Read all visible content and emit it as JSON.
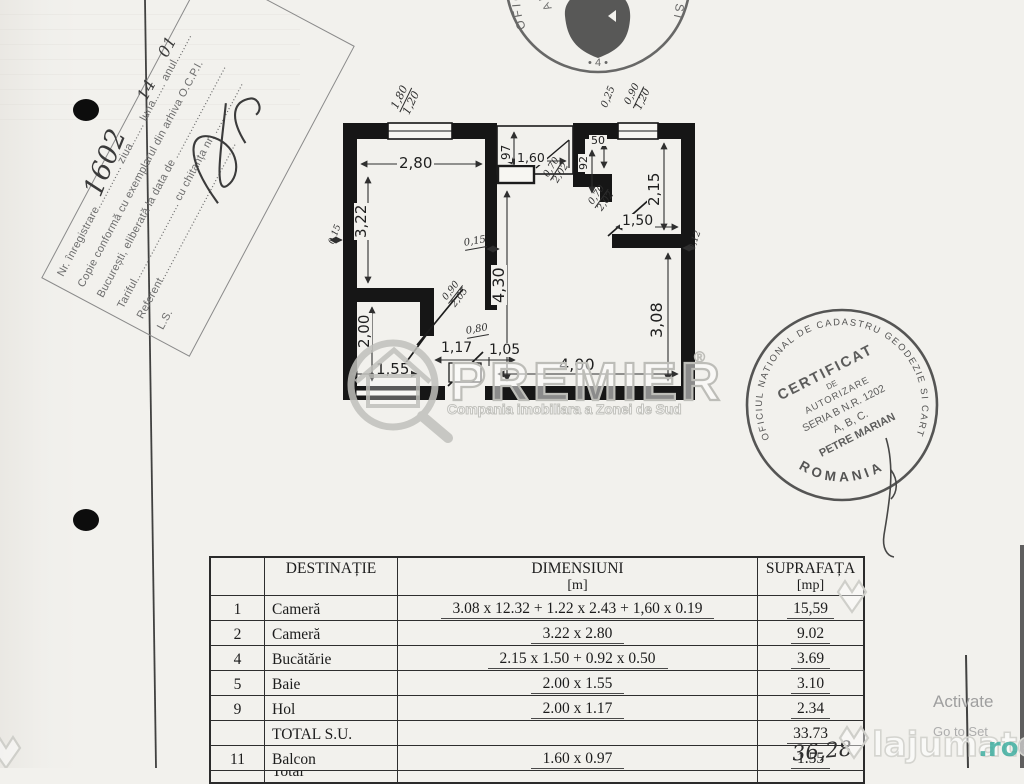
{
  "reg_stamp": {
    "l1": "Nr. înregistrare.............. ziua....... luna...... anul.........",
    "l2": "Copie conformă cu exemplarul din arhiva O.C.P.I.",
    "l3": "București, eliberată la data de ...............................",
    "l4": "Tariful.......................... cu chitanța nr. .................",
    "l5": "Referent..............................................",
    "l6": "L.S.",
    "hw_number": "1602",
    "hw_day": "14",
    "hw_month": "01"
  },
  "top_stamp": {
    "ring": "OFICIUL DE CADASTRU GEODEZIE SI CARTOGRAFIE",
    "inner_ring": "AL MUNICIPIULUI BUCURESTI",
    "mark": "• 4 •"
  },
  "cert_stamp": {
    "ring": "OFICIUL NATIONAL DE CADASTRU GEODEZIE SI CARTOGRAFIE",
    "bottom": "ROMANIA",
    "line1": "CERTIFICAT",
    "line2": "DE",
    "line3": "AUTORIZARE",
    "line4": "SERIA B N.R. 1202",
    "line5": "A, B, C.",
    "line6": "PETRE MARIAN"
  },
  "plan": {
    "dims": {
      "d280": "2,80",
      "d322": "3,22",
      "d97": "97",
      "d160": "1,60",
      "d50": "50",
      "d92": "92",
      "d215": "2,15",
      "d150": "1,50",
      "d430": "4,30",
      "d308": "3,08",
      "d200": "2,00",
      "d117": "1,17",
      "d105": "1,05",
      "d155": "1,55",
      "d400": "4,00",
      "hw025": "0,25",
      "hw012": "0,12",
      "hw015_wall": "0,15",
      "hw015": "0,15",
      "hw080": "0,80"
    },
    "fractions": {
      "win_left": {
        "top": "1,80",
        "bot": "1,20"
      },
      "win_right": {
        "top": "0,90",
        "bot": "1,20"
      },
      "door_balcony": {
        "top": "0,70",
        "bot": "2,02"
      },
      "door_kitchen": {
        "top": "0,70",
        "bot": "2,02"
      },
      "door_room": {
        "top": "0,90",
        "bot": "2,05"
      }
    }
  },
  "watermark_premier": {
    "name": "PREMIER",
    "reg": "®",
    "tagline": "Compania imobiliara a Zonei de Sud"
  },
  "watermark_lajumate": {
    "name": "lajumate",
    "tld": ".ro",
    "accent": "#3fae9f"
  },
  "os_overlay": {
    "line1": "Activate",
    "line2": "Go to Set"
  },
  "table": {
    "headers": {
      "destinatie": "DESTINAȚIE",
      "dimensiuni": "DIMENSIUNI",
      "dim_unit": "[m]",
      "suprafata": "SUPRAFAȚA",
      "supr_unit": "[mp]"
    },
    "rows": [
      {
        "no": "1",
        "dest": "Cameră",
        "dims": "3.08 x 12.32 + 1.22 x 2.43 + 1,60 x 0.19",
        "area": "15,59"
      },
      {
        "no": "2",
        "dest": "Cameră",
        "dims": "3.22 x 2.80",
        "area": "9.02"
      },
      {
        "no": "4",
        "dest": "Bucătărie",
        "dims": "2.15 x 1.50 + 0.92 x 0.50",
        "area": "3.69"
      },
      {
        "no": "5",
        "dest": "Baie",
        "dims": "2.00 x 1.55",
        "area": "3.10"
      },
      {
        "no": "9",
        "dest": "Hol",
        "dims": "2.00 x 1.17",
        "area": "2.34"
      },
      {
        "no": "",
        "dest": "TOTAL S.U.",
        "dims": "",
        "area": "33.73"
      },
      {
        "no": "11",
        "dest": "Balcon",
        "dims": "1.60 x 0.97",
        "area": "1.55"
      },
      {
        "no": "",
        "dest": "Total",
        "dims": "",
        "area": ""
      }
    ],
    "handwritten_total": "36,28"
  }
}
